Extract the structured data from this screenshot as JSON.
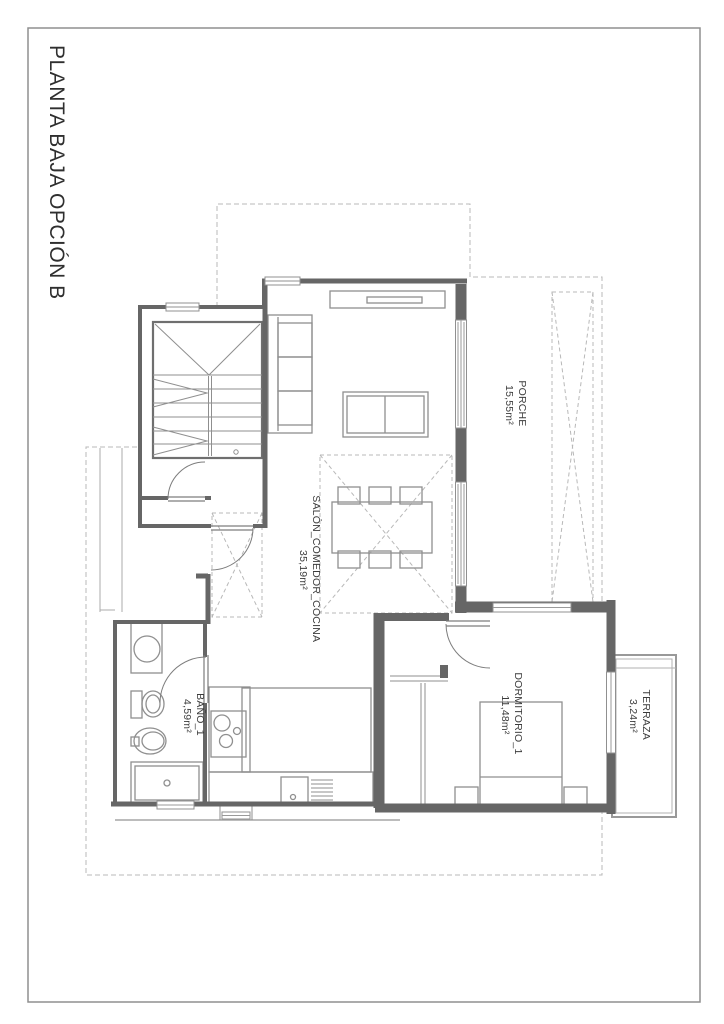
{
  "page": {
    "title": "PLANTA BAJA OPCIÓN B"
  },
  "rooms": [
    {
      "name": "PORCHE",
      "area": "15,55m²"
    },
    {
      "name": "SALÓN_COMEDOR_COCINA",
      "area": "35,19m²"
    },
    {
      "name": "BAÑO_1",
      "area": "4,59m²"
    },
    {
      "name": "DORMITORIO_1",
      "area": "11,48m²"
    },
    {
      "name": "TERRAZA",
      "area": "3,24m²"
    }
  ],
  "colors": {
    "wall": "#666666",
    "furniture": "#8f8f8f",
    "dashed": "#b8b8b8",
    "frame": "#8f8f8f",
    "text": "#3c3c3c",
    "background": "#ffffff"
  }
}
